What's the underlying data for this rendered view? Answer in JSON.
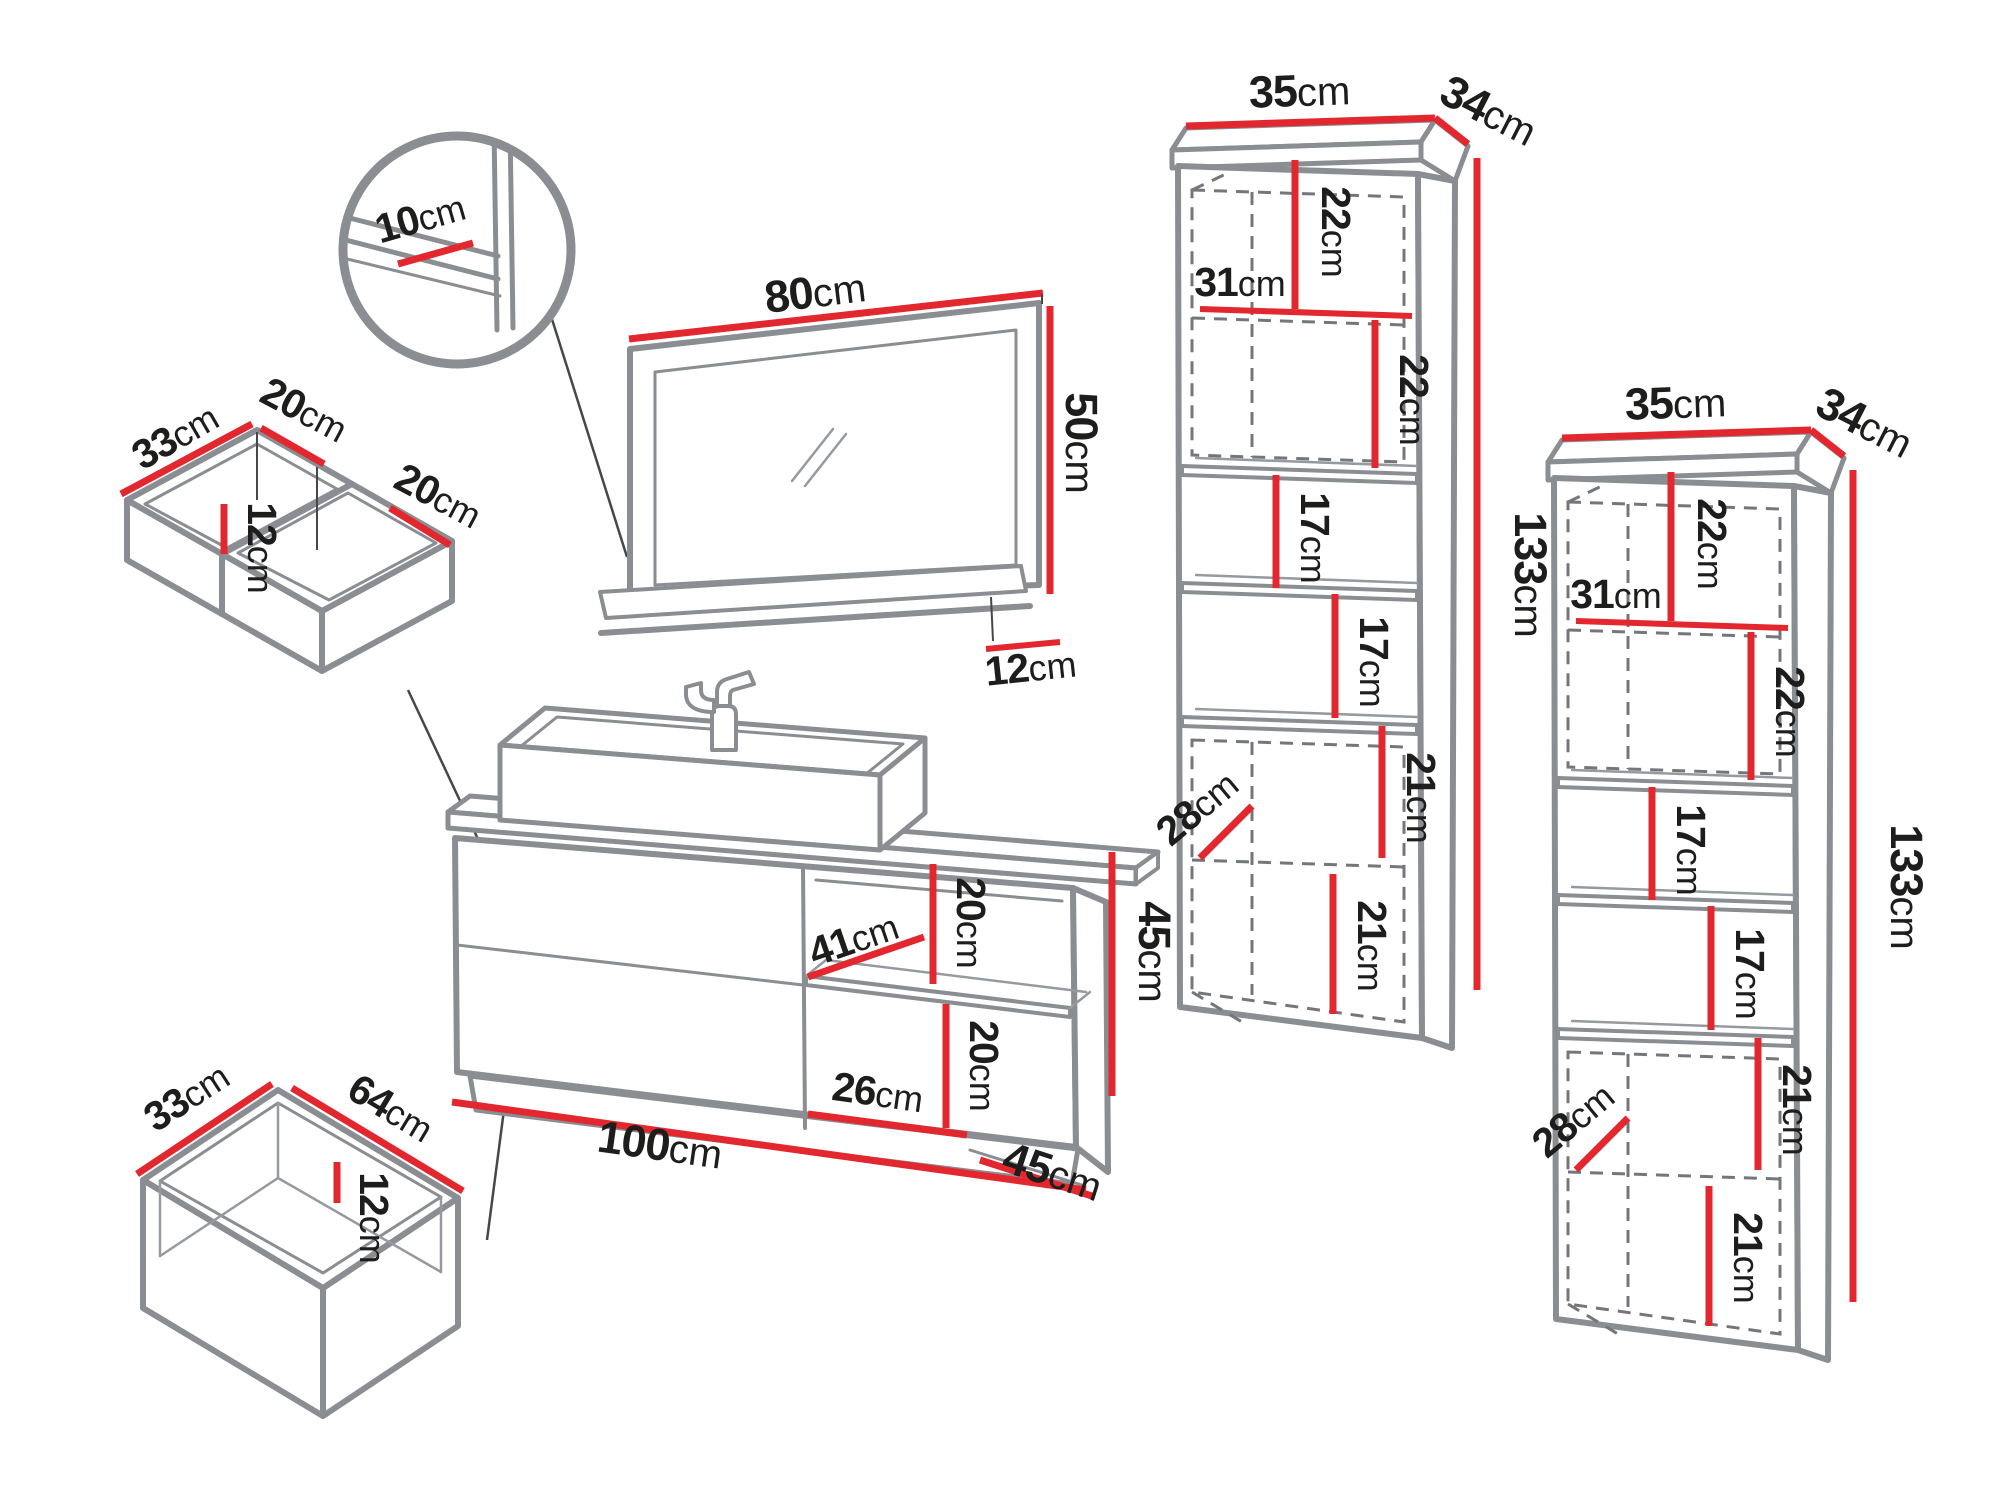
{
  "unit": "cm",
  "colors": {
    "dimension_red": "#e2282e",
    "outline_gray": "#8a8e92",
    "leader_dark": "#45484b",
    "text_black": "#1d1d1b",
    "background": "#ffffff"
  },
  "detail_view": {
    "shelf_depth": "10"
  },
  "mirror": {
    "width": "80",
    "height": "50",
    "shelf_depth": "12"
  },
  "upper_drawer": {
    "depth": "33",
    "back_width": "20",
    "inner_height": "12",
    "front_width": "20"
  },
  "lower_drawer": {
    "depth": "33",
    "width": "64",
    "inner_height": "12"
  },
  "vanity": {
    "width": "100",
    "height": "45",
    "depth": "45",
    "shelf_depth": "41",
    "upper_niche_height": "20",
    "lower_niche_height": "20",
    "niche_width": "26"
  },
  "tall_cabinet": {
    "top_width": "35",
    "top_depth": "34",
    "niche1_height": "22",
    "inner_width": "31",
    "niche2_height": "22",
    "niche3_height": "17",
    "niche4_height": "17",
    "niche5_height": "21",
    "door_depth": "28",
    "niche6_height": "21",
    "height": "133"
  }
}
